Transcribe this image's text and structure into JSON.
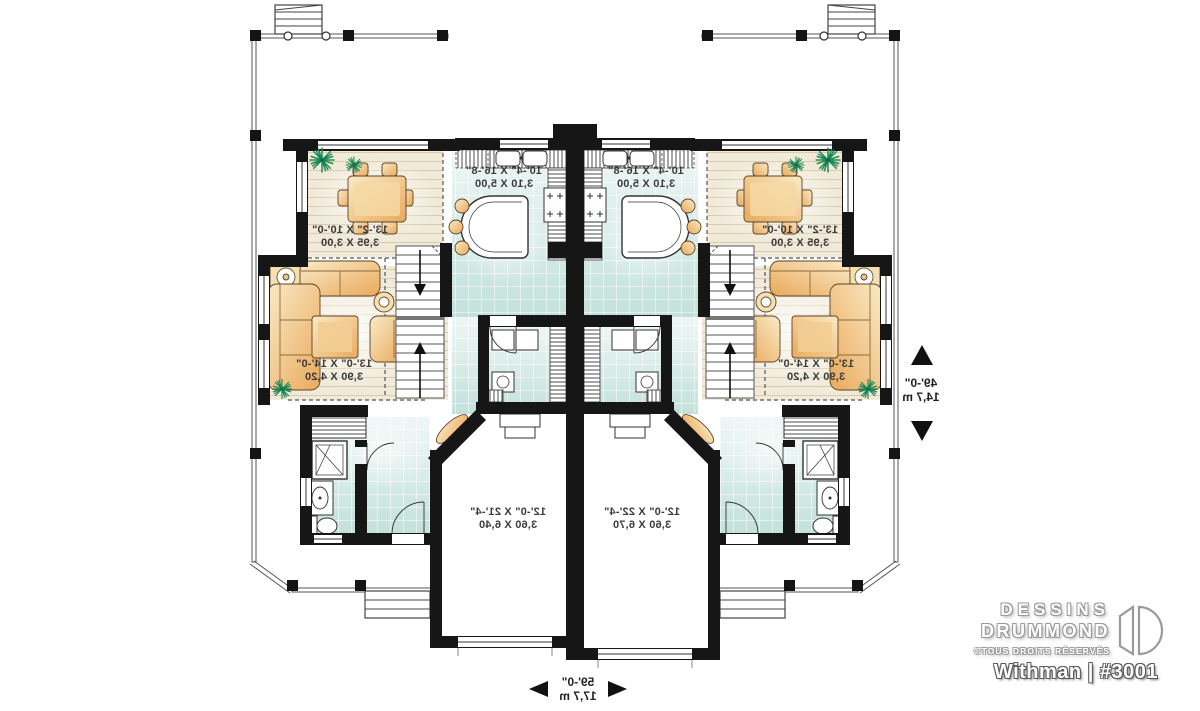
{
  "branding": {
    "brand_line1": "DESSINS",
    "brand_line2": "DRUMMOND",
    "copyright": "©TOUS DROITS RÉSERVÉS",
    "plan_name": "Withman",
    "divider": "|",
    "plan_number": "#3001"
  },
  "rooms": {
    "dining_left": {
      "imperial": "13'-2\" X 10'-0\"",
      "metric": "3,95 X 3,00"
    },
    "kitchen_left": {
      "imperial": "10'-4\" X 16'-8\"",
      "metric": "3,10 X 5,00"
    },
    "living_left": {
      "imperial": "13'-0\" X 14'-0\"",
      "metric": "3,90 X 4,20"
    },
    "garage_left": {
      "imperial": "12'-0\" X 21'-4\"",
      "metric": "3,60 X 6,40"
    },
    "dining_right": {
      "imperial": "13'-2\" X 10'-0\"",
      "metric": "3,95 X 3,00"
    },
    "kitchen_right": {
      "imperial": "10'-4\" X 16'-8\"",
      "metric": "3,10 X 5,00"
    },
    "living_right": {
      "imperial": "13'-0\" X 14'-0\"",
      "metric": "3,90 X 4,20"
    },
    "garage_right": {
      "imperial": "12'-0\" X 22'-4\"",
      "metric": "3,60 X 6,70"
    }
  },
  "dimensions": {
    "depth": {
      "imperial": "49'-0\"",
      "metric": "14,7 m"
    },
    "width": {
      "imperial": "59'-0\"",
      "metric": "17,7 m"
    }
  }
}
